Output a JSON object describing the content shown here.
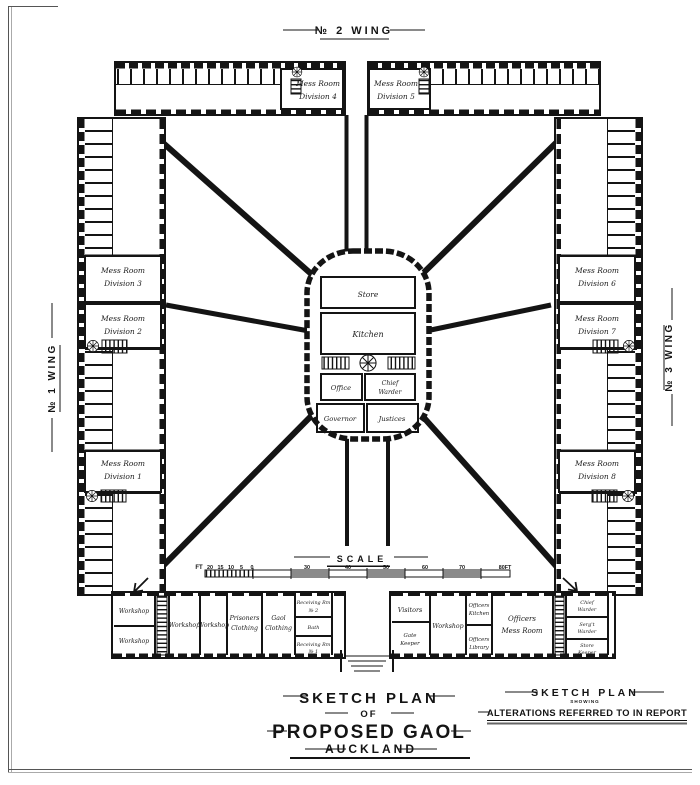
{
  "colors": {
    "ink": "#141414",
    "paper": "#ffffff",
    "bar_shade": "#8a8a8a"
  },
  "wings": {
    "top": "№ 2  WING",
    "left": "№ 1  WING",
    "right": "№ 3  WING"
  },
  "mess": {
    "d1": {
      "l1": "Mess Room",
      "l2": "Division 1"
    },
    "d2": {
      "l1": "Mess Room",
      "l2": "Division 2"
    },
    "d3": {
      "l1": "Mess Room",
      "l2": "Division 3"
    },
    "d4": {
      "l1": "Mess Room",
      "l2": "Division 4"
    },
    "d5": {
      "l1": "Mess Room",
      "l2": "Division 5"
    },
    "d6": {
      "l1": "Mess Room",
      "l2": "Division 6"
    },
    "d7": {
      "l1": "Mess Room",
      "l2": "Division 7"
    },
    "d8": {
      "l1": "Mess Room",
      "l2": "Division 8"
    }
  },
  "central": {
    "store": "Store",
    "kitchen": "Kitchen",
    "office": "Office",
    "chief_warder": {
      "l1": "Chief",
      "l2": "Warder"
    },
    "governor": "Governor",
    "justices": "Justices"
  },
  "bottom_left": {
    "workshop": "Workshop",
    "prisoners_clothing": {
      "l1": "Prisoners",
      "l2": "Clothing"
    },
    "gaol_clothing": {
      "l1": "Gaol",
      "l2": "Clothing"
    },
    "receiving2": {
      "l1": "Receiving Rm",
      "l2": "№ 2"
    },
    "bath": "Bath",
    "receiving1": {
      "l1": "Receiving Rm",
      "l2": "№ 1"
    }
  },
  "bottom_right": {
    "visitors": "Visitors",
    "gate_keeper": {
      "l1": "Gate",
      "l2": "Keeper"
    },
    "workshop": "Workshop",
    "officers_kitchen": {
      "l1": "Officers",
      "l2": "Kitchen"
    },
    "officers_library": {
      "l1": "Officers",
      "l2": "Library"
    },
    "officers_mess": {
      "l1": "Officers",
      "l2": "Mess Room"
    },
    "chief_warder": {
      "l1": "Chief",
      "l2": "Warder"
    },
    "sergt_warder": {
      "l1": "Serg't",
      "l2": "Warder"
    },
    "store_keeper": {
      "l1": "Store",
      "l2": "Keeper"
    }
  },
  "scale": {
    "label": "SCALE",
    "prefix": "FT",
    "left_ticks": [
      "20",
      "15",
      "10",
      "5",
      "0"
    ],
    "main_ticks": [
      "30",
      "40",
      "50",
      "60",
      "70"
    ],
    "end": "80FT"
  },
  "title_main": {
    "l1": "SKETCH PLAN",
    "l2": "OF",
    "l3": "PROPOSED GAOL",
    "l4": "AUCKLAND"
  },
  "title_right": {
    "l1": "SKETCH PLAN",
    "l2": "SHOWING",
    "l3": "ALTERATIONS REFERRED TO IN REPORT"
  }
}
